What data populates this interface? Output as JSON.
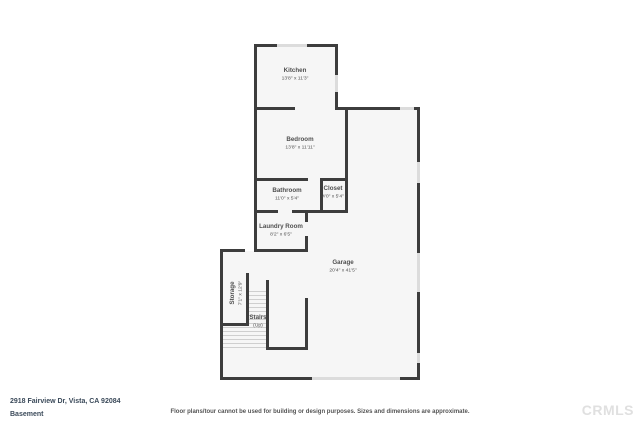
{
  "footer": {
    "address": "2918 Fairview Dr, Vista, CA 92084",
    "level": "Basement",
    "disclaimer": "Floor plans/tour cannot be used for building or design purposes. Sizes and dimensions are approximate.",
    "watermark": "CRMLS"
  },
  "floorplan": {
    "colors": {
      "wall": "#3d3d3d",
      "floor": "#f6f6f6",
      "window": "#dcdcdc",
      "tread": "#cfcfcf",
      "label": "#4f4f4f"
    },
    "rooms": [
      {
        "id": "kitchen",
        "name": "Kitchen",
        "dims": "13'8\" x 11'3\"",
        "x": 295,
        "y": 74
      },
      {
        "id": "bedroom",
        "name": "Bedroom",
        "dims": "13'8\" x 11'11\"",
        "x": 300,
        "y": 143
      },
      {
        "id": "bathroom",
        "name": "Bathroom",
        "dims": "11'0\" x 5'4\"",
        "x": 287,
        "y": 194
      },
      {
        "id": "closet",
        "name": "Closet",
        "dims": "4'0\" x 5'4\"",
        "x": 333,
        "y": 192
      },
      {
        "id": "laundry-room",
        "name": "Laundry Room",
        "dims": "8'2\" x 6'5\"",
        "x": 281,
        "y": 230
      },
      {
        "id": "garage",
        "name": "Garage",
        "dims": "20'4\" x 41'5\"",
        "x": 343,
        "y": 266
      },
      {
        "id": "storage",
        "name": "Storage",
        "dims": "7'1\" x 12'9\"",
        "x": 236,
        "y": 293,
        "rotate": true
      },
      {
        "id": "stairs",
        "name": "Stairs",
        "dims": "(Up)",
        "x": 258,
        "y": 321
      }
    ],
    "fills": [
      [
        254,
        44,
        81,
        65
      ],
      [
        254,
        109,
        91,
        71
      ],
      [
        254,
        180,
        91,
        32
      ],
      [
        254,
        212,
        51,
        39
      ],
      [
        345,
        109,
        73,
        104
      ],
      [
        305,
        213,
        113,
        38
      ],
      [
        220,
        251,
        198,
        128
      ]
    ],
    "walls_h": [
      [
        254,
        44,
        23
      ],
      [
        307,
        44,
        31
      ],
      [
        254,
        107,
        41
      ],
      [
        335,
        107,
        65
      ],
      [
        414,
        107,
        6
      ],
      [
        254,
        178,
        54
      ],
      [
        320,
        178,
        27
      ],
      [
        254,
        210,
        24
      ],
      [
        292,
        210,
        56
      ],
      [
        220,
        249,
        25
      ],
      [
        254,
        249,
        54
      ],
      [
        220,
        323,
        29
      ],
      [
        266,
        347,
        42
      ],
      [
        220,
        377,
        92
      ],
      [
        400,
        377,
        20
      ]
    ],
    "walls_v": [
      [
        254,
        44,
        207
      ],
      [
        335,
        44,
        31
      ],
      [
        335,
        92,
        18
      ],
      [
        345,
        107,
        106
      ],
      [
        320,
        178,
        35
      ],
      [
        305,
        210,
        12
      ],
      [
        305,
        236,
        16
      ],
      [
        220,
        249,
        131
      ],
      [
        246,
        273,
        52
      ],
      [
        266,
        280,
        70
      ],
      [
        305,
        298,
        52
      ],
      [
        417,
        107,
        55
      ],
      [
        417,
        183,
        70
      ],
      [
        417,
        292,
        61
      ],
      [
        417,
        363,
        17
      ]
    ],
    "windows_h": [
      [
        277,
        44,
        30
      ],
      [
        400,
        107,
        14
      ],
      [
        312,
        377,
        88
      ]
    ],
    "windows_v": [
      [
        335,
        75,
        17
      ],
      [
        417,
        162,
        21
      ],
      [
        417,
        253,
        39
      ],
      [
        417,
        353,
        10
      ]
    ],
    "treads": [
      {
        "x": 249,
        "y": 291,
        "w": 17,
        "count": 9,
        "gap": 4
      },
      {
        "x": 223,
        "y": 327,
        "w": 43,
        "count": 6,
        "gap": 4
      }
    ]
  }
}
